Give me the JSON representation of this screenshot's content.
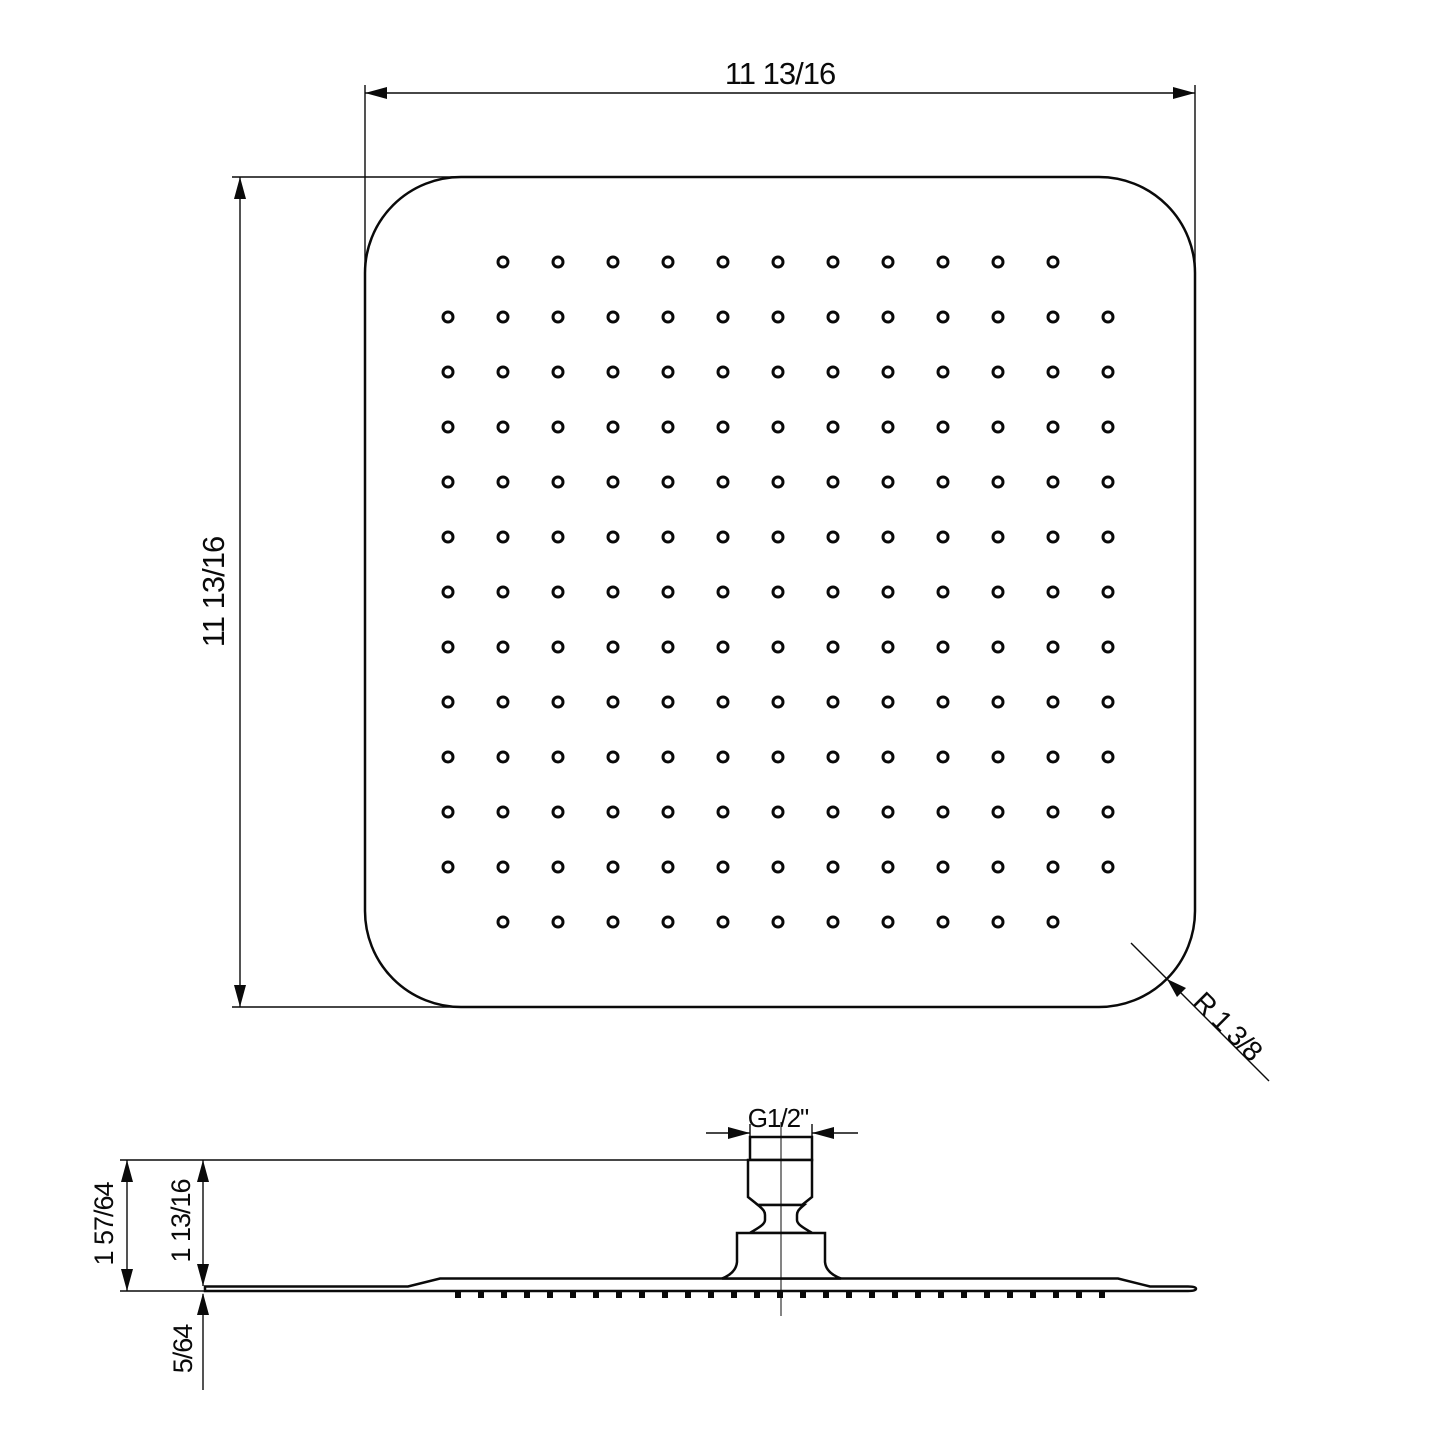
{
  "top_view": {
    "width_label": "11  13/16",
    "height_label": "11  13/16",
    "corner_radius_label": "R 1 3/8"
  },
  "side_view": {
    "total_height_label": "1 57/64",
    "head_height_label": "1 13/16",
    "edge_thickness_label": "5/64",
    "thread_label": "G1/2\""
  },
  "nozzle_grid": {
    "rows": 13,
    "cols": 13,
    "spacing": 55,
    "start_x": 448,
    "start_y": 262,
    "hole_radius": 5,
    "omit_corner_holes": true,
    "total_holes": 165
  },
  "nozzle_ticks": {
    "start_x": 458,
    "end_x": 1102,
    "step": 23,
    "width": 6,
    "height": 7,
    "y": 1291
  },
  "colors": {
    "line": "#0a0a0a",
    "background": "#ffffff"
  }
}
